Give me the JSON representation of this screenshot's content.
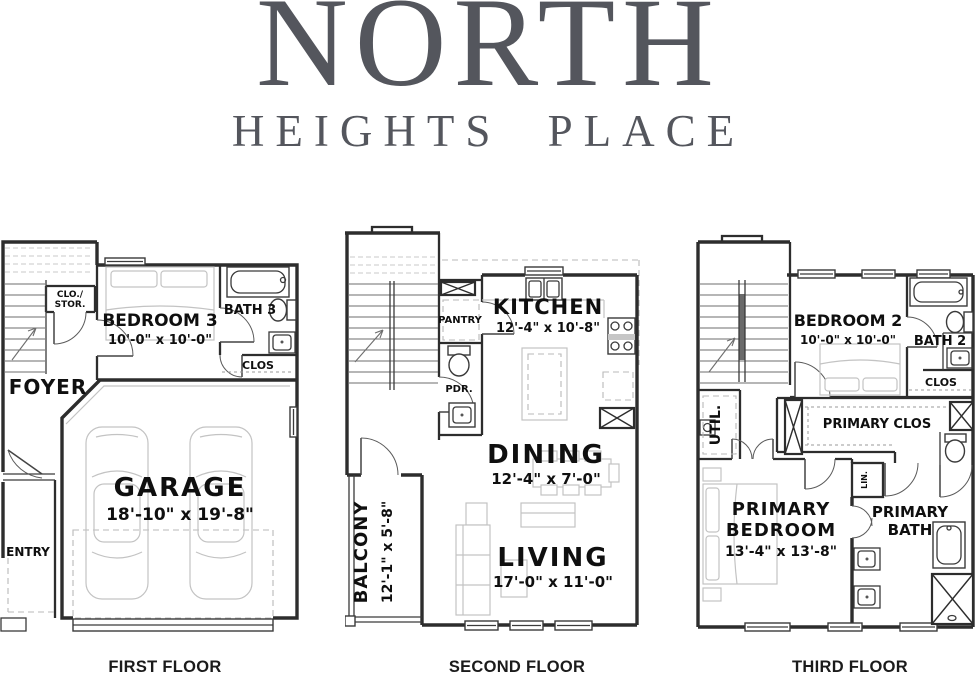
{
  "title": {
    "line1": "NORTH",
    "line2": "HEIGHTS PLACE"
  },
  "colors": {
    "title": "#54565d",
    "walls": "#2d2d2d",
    "furniture": "#c3c3c3",
    "label_text": "#0f0f0f"
  },
  "floor1": {
    "caption": "FIRST FLOOR",
    "clos_stor_line1": "CLO./",
    "clos_stor_line2": "STOR.",
    "bedroom3": "BEDROOM 3",
    "bedroom3_dim": "10'-0\" x 10'-0\"",
    "bath3": "BATH 3",
    "clos": "CLOS",
    "foyer": "FOYER",
    "garage": "GARAGE",
    "garage_dim": "18'-10\" x 19'-8\"",
    "entry": "ENTRY"
  },
  "floor2": {
    "caption": "SECOND FLOOR",
    "pantry": "PANTRY",
    "kitchen": "KITCHEN",
    "kitchen_dim": "12'-4\" x 10'-8\"",
    "pdr": "PDR.",
    "dining": "DINING",
    "dining_dim": "12'-4\" x 7'-0\"",
    "living": "LIVING",
    "living_dim": "17'-0\" x 11'-0\"",
    "balcony": "BALCONY",
    "balcony_dim": "12'-1\" x 5'-8\""
  },
  "floor3": {
    "caption": "THIRD FLOOR",
    "bedroom2": "BEDROOM 2",
    "bedroom2_dim": "10'-0\" x 10'-0\"",
    "bath2": "BATH 2",
    "clos": "CLOS",
    "util": "UTIL.",
    "primary_clos": "PRIMARY CLOS",
    "lin": "LIN.",
    "primary_bedroom_line1": "PRIMARY",
    "primary_bedroom_line2": "BEDROOM",
    "primary_bedroom_dim": "13'-4\" x 13'-8\"",
    "primary_bath_line1": "PRIMARY",
    "primary_bath_line2": "BATH"
  }
}
